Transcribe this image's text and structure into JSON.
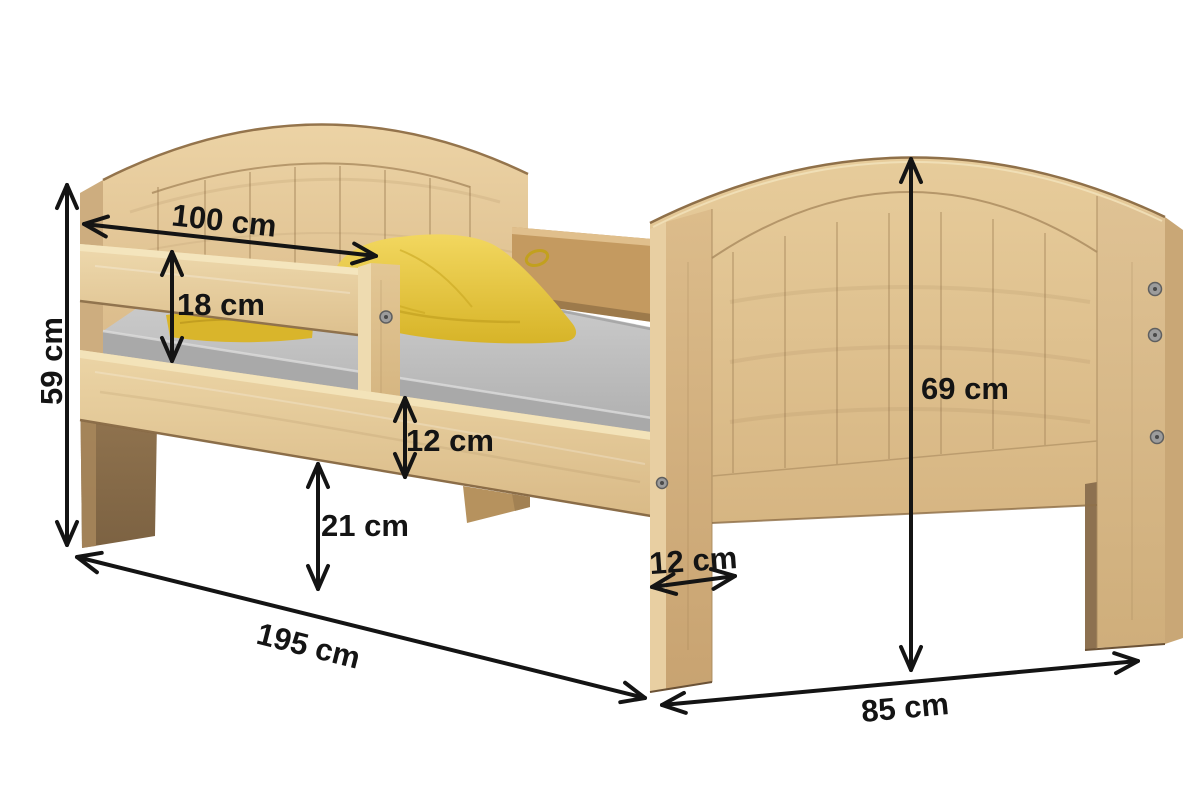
{
  "diagram": {
    "subject": "children-bed-with-guard-rail",
    "unit": "cm",
    "measurements": {
      "headboard_width": "100 cm",
      "guard_rail_height": "18 cm",
      "headboard_height": "59 cm",
      "side_rail_height": "12 cm",
      "under_bed_clearance": "21 cm",
      "bed_length": "195 cm",
      "foot_leg_width": "12 cm",
      "footboard_height": "69 cm",
      "footboard_width": "85 cm"
    },
    "colors": {
      "background": "#ffffff",
      "wood_light": "#ecd3a5",
      "wood_mid": "#d9b988",
      "wood_rail_far": "#c49a60",
      "wood_leg_dark": "#8a6d4e",
      "mattress_gray": "#c0c0c0",
      "duvet_yellow": "#e8c636",
      "dimension_ink": "#141414"
    }
  }
}
